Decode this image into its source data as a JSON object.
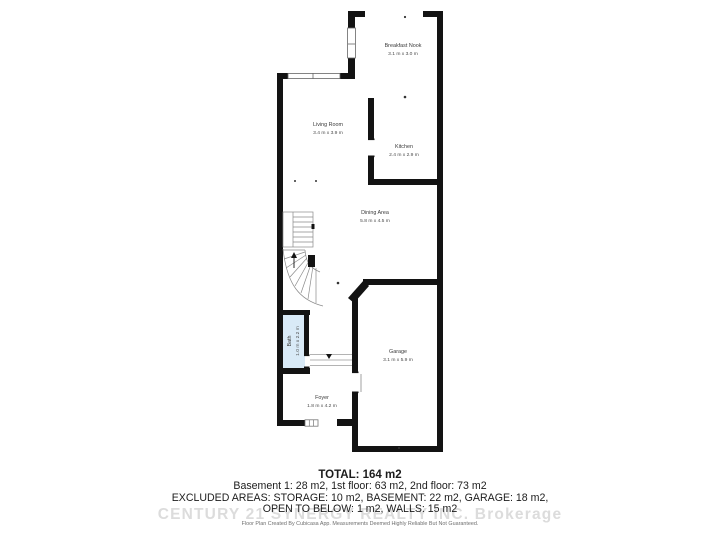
{
  "plan": {
    "rooms": [
      {
        "name": "Breakfast Nook",
        "dims": "3.1 m x 3.0 m"
      },
      {
        "name": "Living Room",
        "dims": "3.4 m x 3.9 m"
      },
      {
        "name": "Kitchen",
        "dims": "2.4 m x 2.9 m"
      },
      {
        "name": "Dining Area",
        "dims": "5.8 m x 4.5 m"
      },
      {
        "name": "Garage",
        "dims": "3.1 m x 5.9 m"
      },
      {
        "name": "Bath",
        "dims": "1.0 m x 2.2 m"
      },
      {
        "name": "Foyer",
        "dims": "1.8 m x 4.2 m"
      }
    ],
    "colors": {
      "wall": "#131313",
      "bath_fill": "#d9eaf7",
      "thin_line": "#8a8a8a",
      "label": "#3a3a3a"
    }
  },
  "summary": {
    "total": "TOTAL: 164 m2",
    "floors": "Basement 1: 28 m2, 1st floor: 63 m2, 2nd floor: 73 m2",
    "excluded_1": "EXCLUDED AREAS: STORAGE: 10 m2, BASEMENT: 22 m2, GARAGE: 18 m2,",
    "excluded_2": "OPEN TO BELOW: 1 m2, WALLS: 15 m2",
    "watermark": "CENTURY 21 SYNERGY REALTY INC. Brokerage",
    "disclaimer": "Floor Plan Created By Cubicasa App. Measurements Deemed Highly Reliable But Not Guaranteed."
  }
}
